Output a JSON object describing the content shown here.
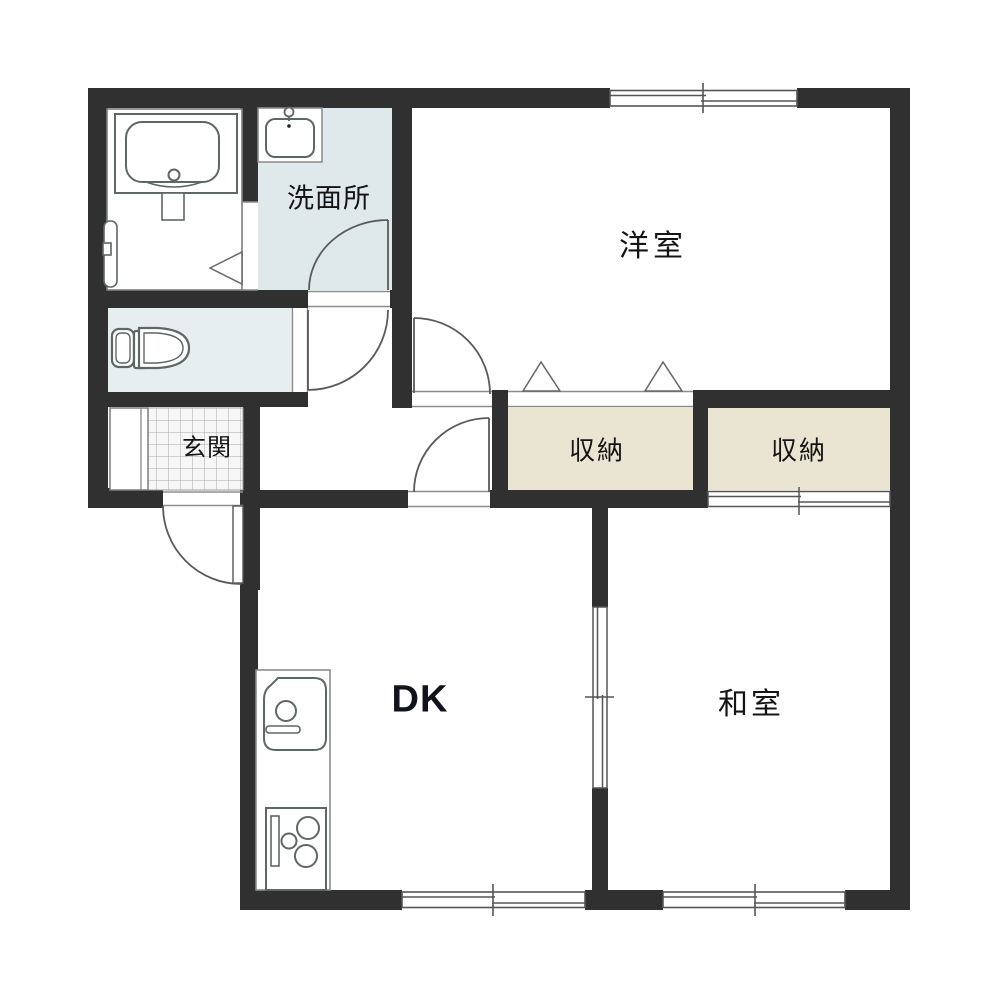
{
  "plan": {
    "type": "apartment-floor-plan",
    "labels": {
      "washroom": "洗面所",
      "entrance": "玄関",
      "western_room": "洋室",
      "closet_left": "収納",
      "closet_right": "収納",
      "dining_kitchen": "DK",
      "japanese_room": "和室"
    },
    "colors": {
      "wall": "#303030",
      "washroom_floor": "#dfe9ec",
      "toilet_floor": "#e7eef0",
      "closet_floor": "#eae5d3",
      "room_floor": "#ffffff",
      "line": "#555555",
      "fixture_line": "#5f6666",
      "tile_line": "#a8a8a8"
    },
    "fixtures": [
      "bathtub",
      "toilet",
      "washbasin",
      "kitchen-sink",
      "stove"
    ]
  }
}
